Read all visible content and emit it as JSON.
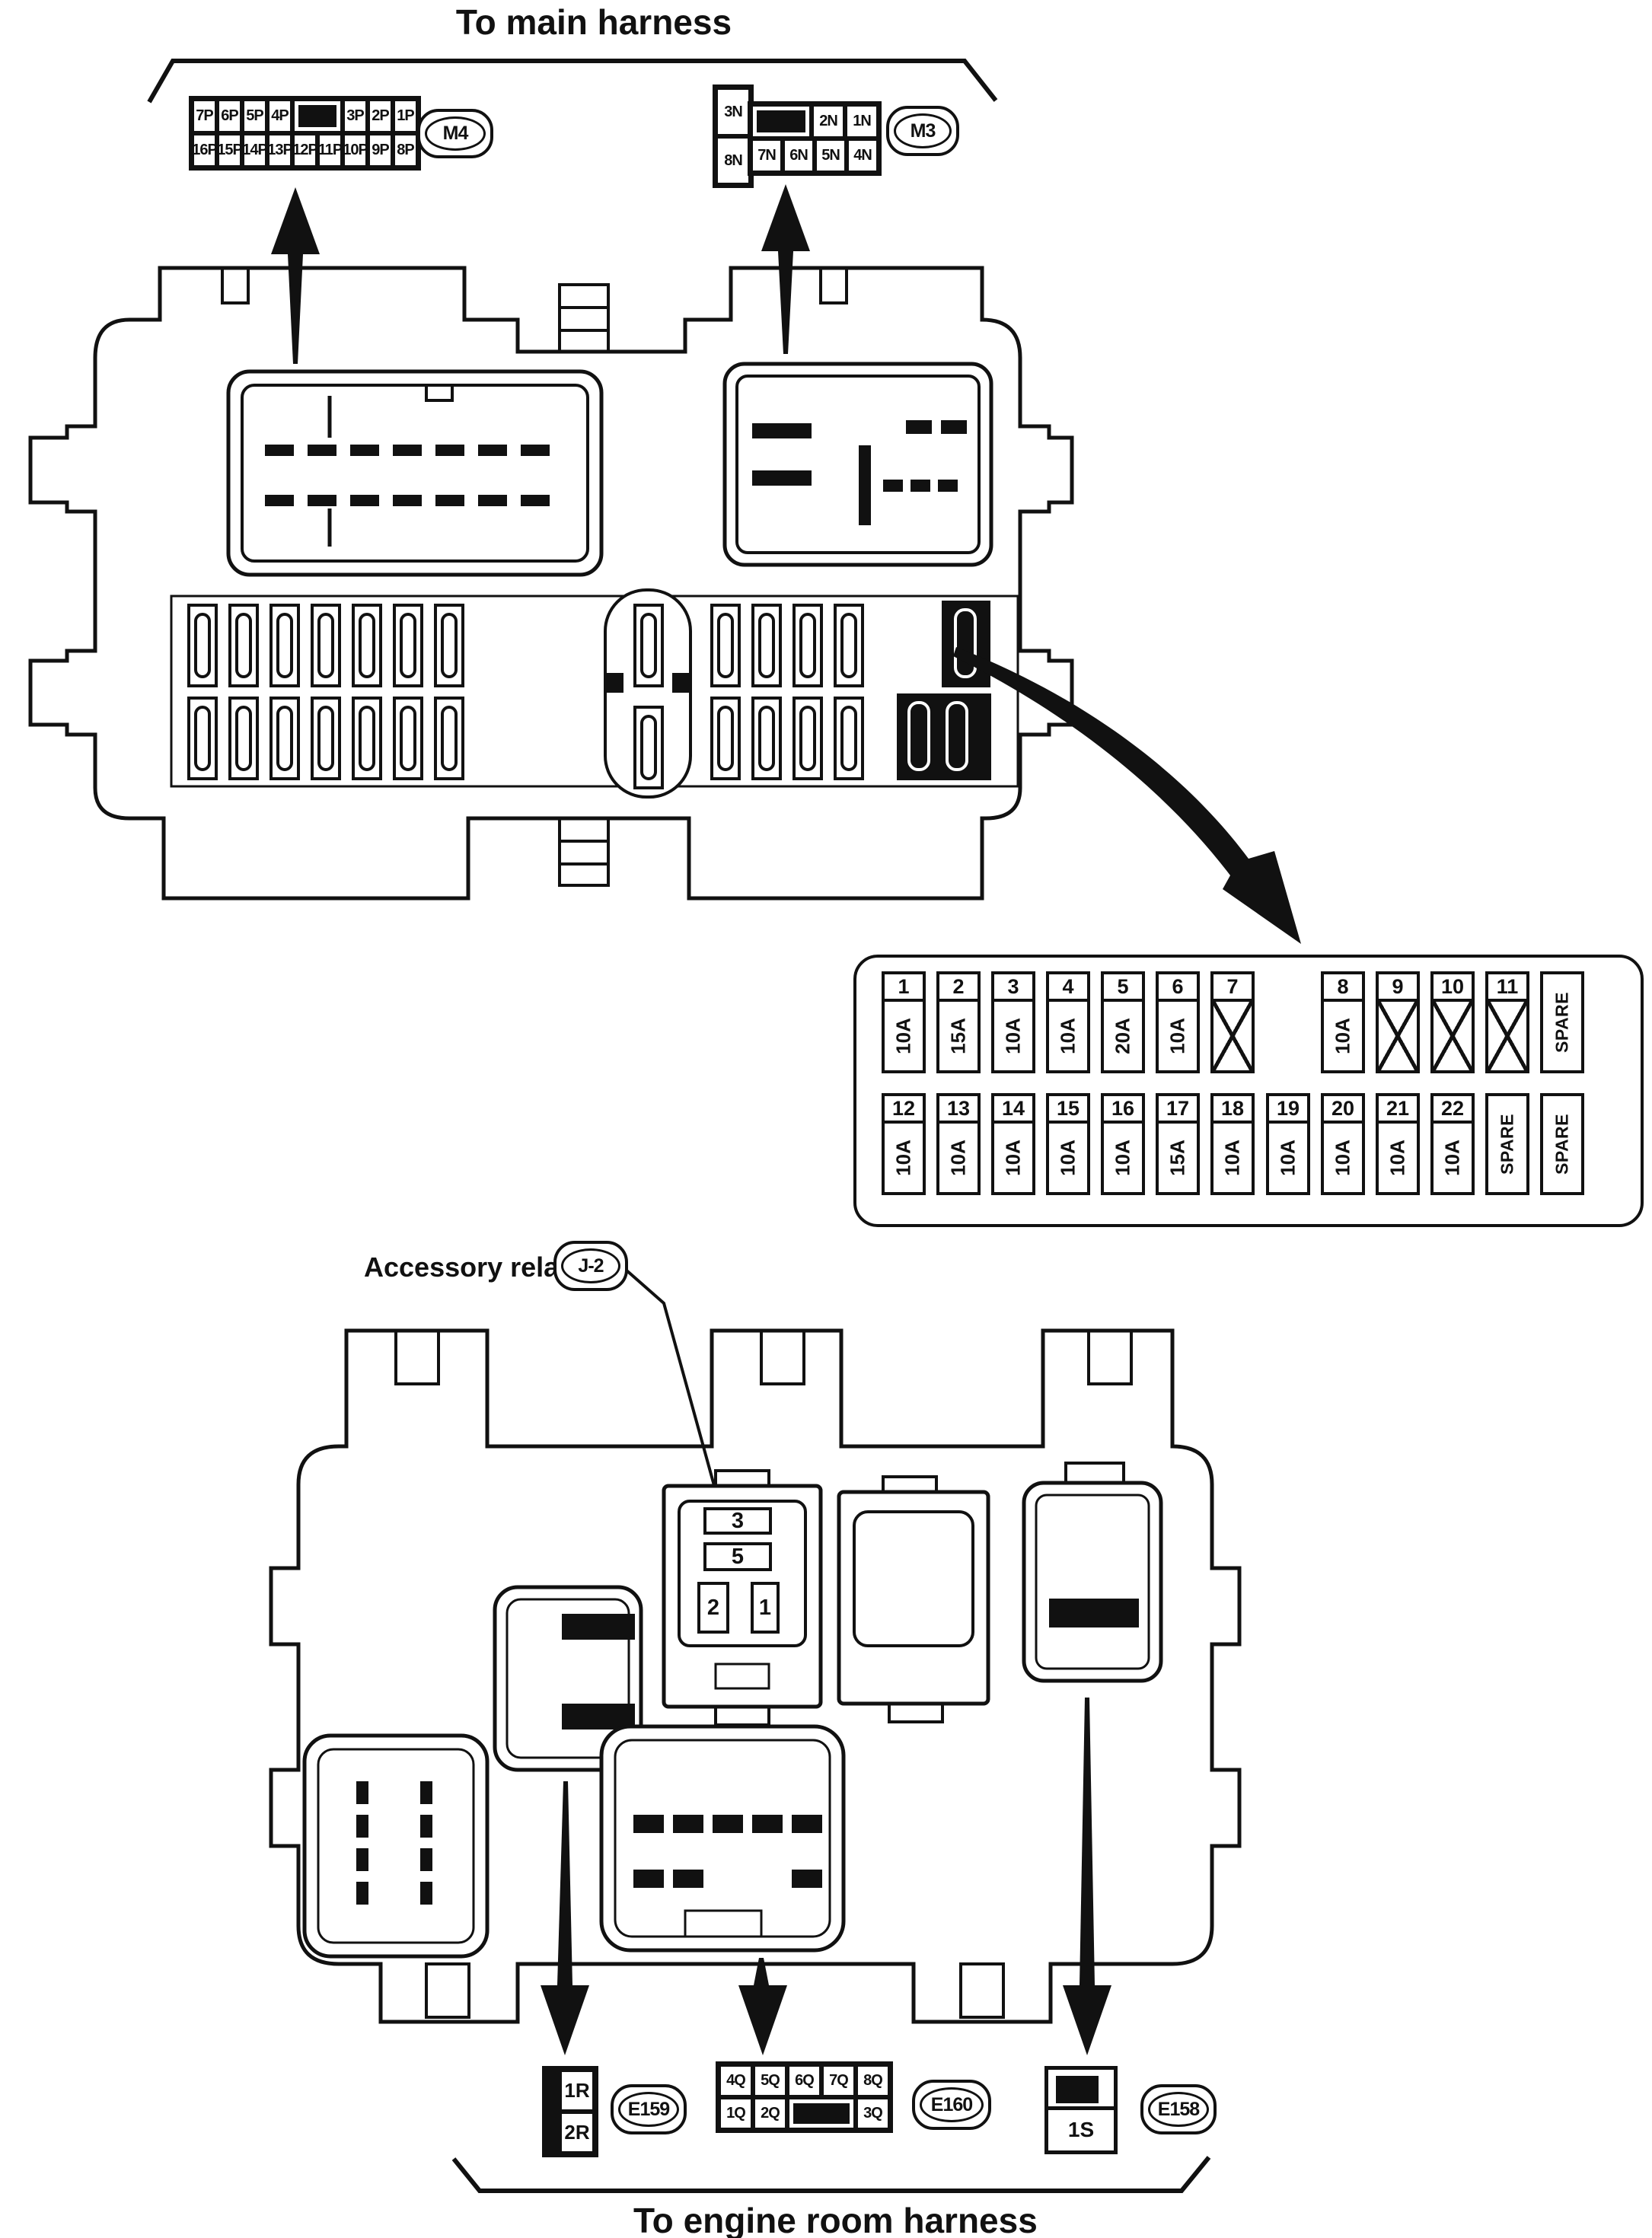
{
  "colors": {
    "ink": "#111111",
    "bg": "#ffffff"
  },
  "top_harness": {
    "title": "To main harness",
    "m4": {
      "tag": "M4",
      "row1": [
        "7P",
        "6P",
        "5P",
        "4P",
        "3P",
        "2P",
        "1P"
      ],
      "row2": [
        "16P",
        "15P",
        "14P",
        "13P",
        "12P",
        "11P",
        "10P",
        "9P",
        "8P"
      ]
    },
    "m3": {
      "tag": "M3",
      "left_top": "3N",
      "left_bottom": "8N",
      "row1": [
        "2N",
        "1N"
      ],
      "row2": [
        "7N",
        "6N",
        "5N",
        "4N"
      ]
    }
  },
  "fuse_table": {
    "row1": [
      {
        "no": "1",
        "rating": "10A"
      },
      {
        "no": "2",
        "rating": "15A"
      },
      {
        "no": "3",
        "rating": "10A"
      },
      {
        "no": "4",
        "rating": "10A"
      },
      {
        "no": "5",
        "rating": "20A"
      },
      {
        "no": "6",
        "rating": "10A"
      },
      {
        "no": "7",
        "rating": "",
        "x": true
      },
      {
        "no": "8",
        "rating": "10A"
      },
      {
        "no": "9",
        "rating": "",
        "x": true
      },
      {
        "no": "10",
        "rating": "",
        "x": true
      },
      {
        "no": "11",
        "rating": "",
        "x": true
      },
      {
        "label": "SPARE"
      }
    ],
    "row2": [
      {
        "no": "12",
        "rating": "10A"
      },
      {
        "no": "13",
        "rating": "10A"
      },
      {
        "no": "14",
        "rating": "10A"
      },
      {
        "no": "15",
        "rating": "10A"
      },
      {
        "no": "16",
        "rating": "10A"
      },
      {
        "no": "17",
        "rating": "15A"
      },
      {
        "no": "18",
        "rating": "10A"
      },
      {
        "no": "19",
        "rating": "10A"
      },
      {
        "no": "20",
        "rating": "10A"
      },
      {
        "no": "21",
        "rating": "10A"
      },
      {
        "no": "22",
        "rating": "10A"
      },
      {
        "label": "SPARE"
      },
      {
        "label2": "SPARE"
      }
    ]
  },
  "accessory_relay": {
    "label": "Accessory relay",
    "tag": "J-2",
    "socket": {
      "c3": "3",
      "c5": "5",
      "c2": "2",
      "c1": "1"
    }
  },
  "engine_harness": {
    "title": "To engine room harness",
    "e159": {
      "tag": "E159",
      "cells": [
        "1R",
        "2R"
      ]
    },
    "e160": {
      "tag": "E160",
      "row1": [
        "4Q",
        "5Q",
        "6Q",
        "7Q",
        "8Q"
      ],
      "row2": [
        "1Q",
        "2Q",
        "3Q"
      ]
    },
    "e158": {
      "tag": "E158",
      "cell": "1S"
    }
  }
}
